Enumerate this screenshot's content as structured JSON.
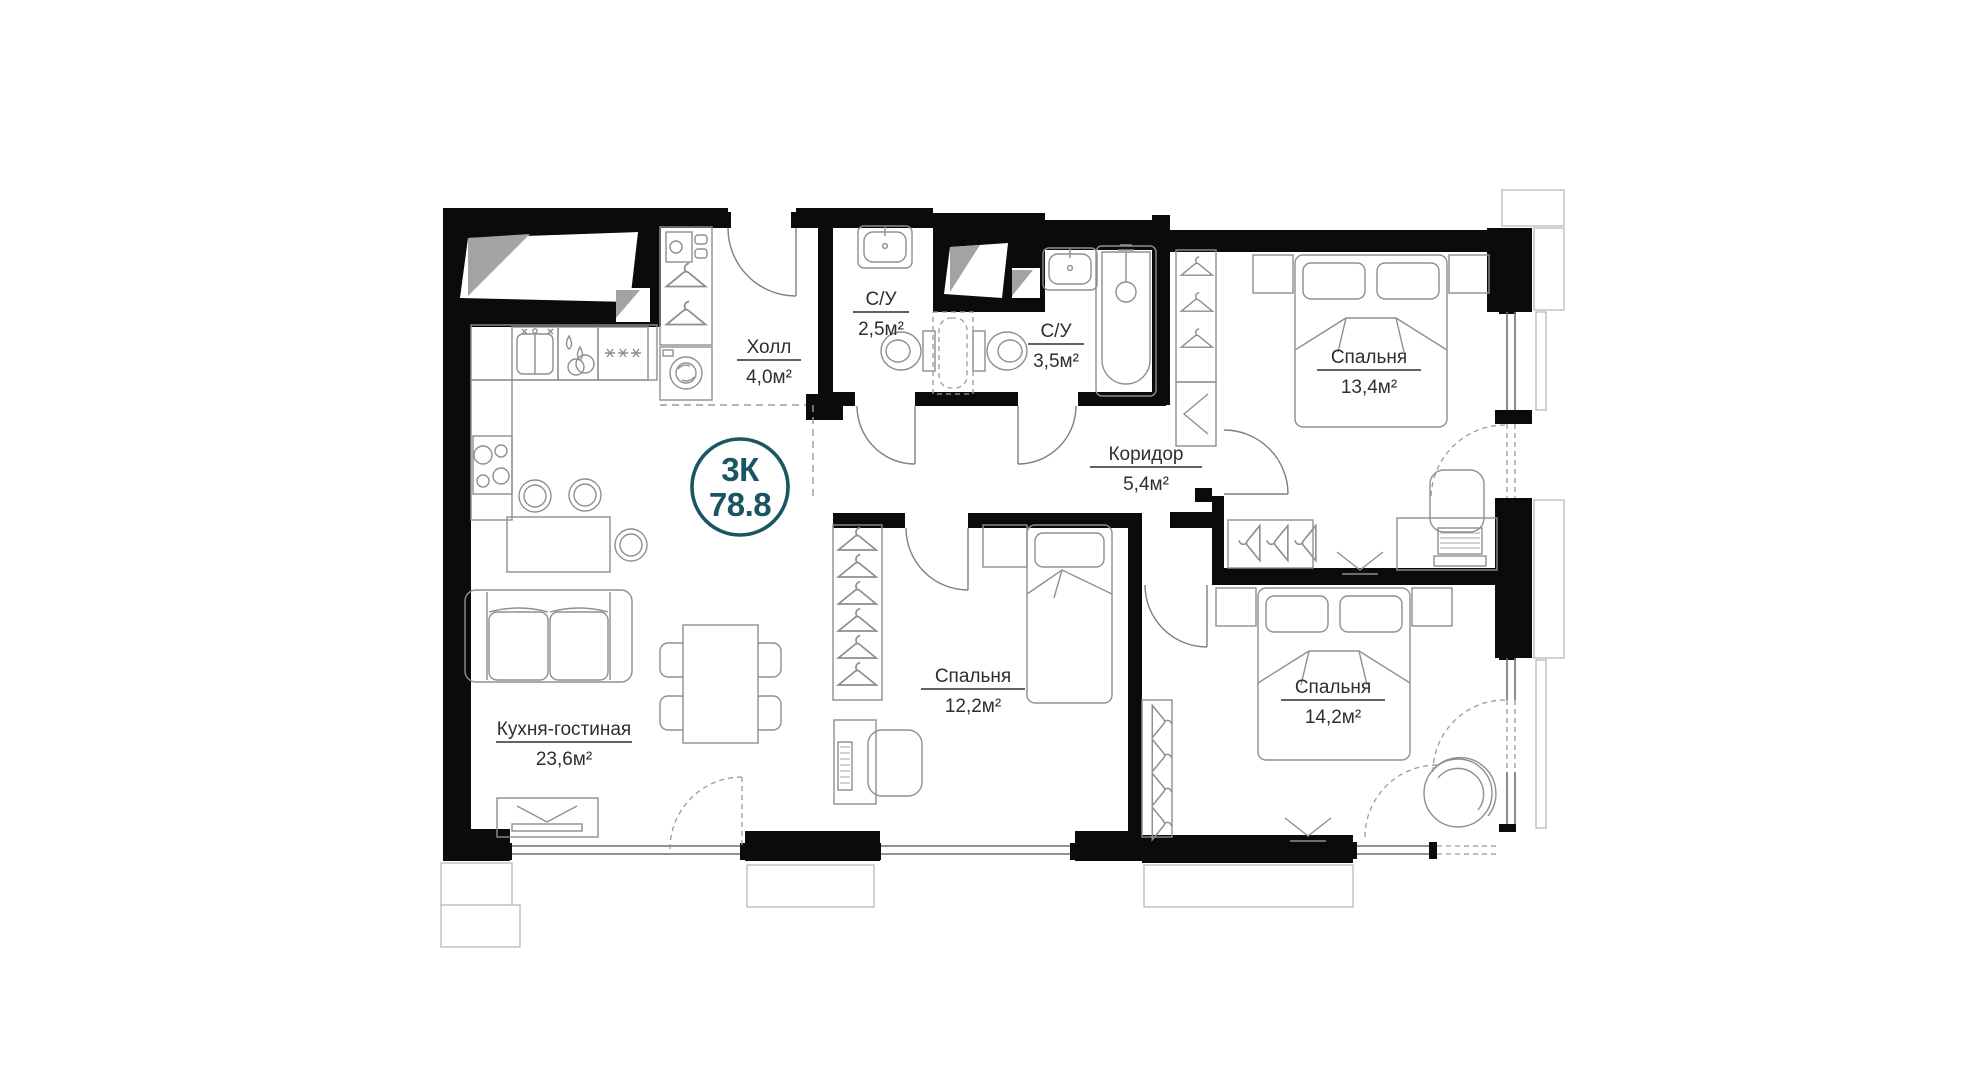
{
  "plan": {
    "title": "Apartment floor plan",
    "badge": {
      "type": "3К",
      "area": "78.8"
    },
    "rooms": [
      {
        "id": "kitchen-living",
        "name": "Кухня-гостиная",
        "area": "23,6м²"
      },
      {
        "id": "hall",
        "name": "Холл",
        "area": "4,0м²"
      },
      {
        "id": "bathroom-small",
        "name": "С/У",
        "area": "2,5м²"
      },
      {
        "id": "bathroom-big",
        "name": "С/У",
        "area": "3,5м²"
      },
      {
        "id": "corridor",
        "name": "Коридор",
        "area": "5,4м²"
      },
      {
        "id": "bedroom-13",
        "name": "Спальня",
        "area": "13,4м²"
      },
      {
        "id": "bedroom-12",
        "name": "Спальня",
        "area": "12,2м²"
      },
      {
        "id": "bedroom-14",
        "name": "Спальня",
        "area": "14,2м²"
      }
    ],
    "colors": {
      "background": "#ffffff",
      "walls": "#0b0b0b",
      "furniture_stroke": "#8f8f8f",
      "label_text": "#2e2e2e",
      "accent_badge": "#1a5562",
      "shaft_shading": "#a3a3a3"
    },
    "icons": {
      "legend": [
        "hanger-icon",
        "washing-machine-icon",
        "kitchen-sink-icon",
        "dish-drying-icon",
        "fridge-stars-icon",
        "stove-icon",
        "bar-stool-icon",
        "sofa-icon",
        "tv-stand-icon",
        "dining-table-icon",
        "bathroom-sink-icon",
        "toilet-icon",
        "bathtub-icon",
        "double-bed-icon",
        "single-bed-icon",
        "nightstand-icon",
        "desk-icon",
        "office-chair-icon",
        "armchair-icon",
        "door-swing-icon",
        "window-icon"
      ]
    }
  }
}
